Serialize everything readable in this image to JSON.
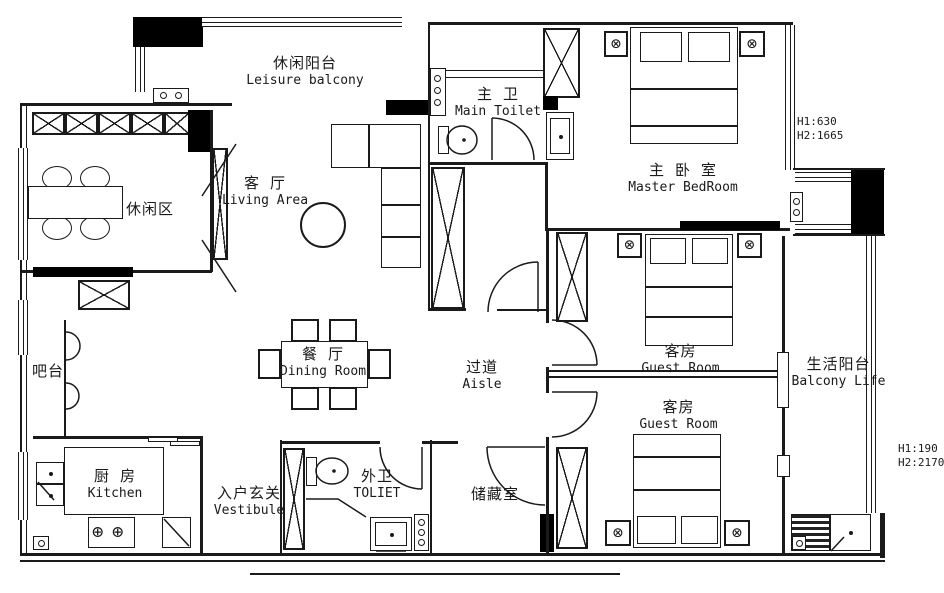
{
  "plan": {
    "rooms": {
      "leisure_balcony": {
        "zh": "休闲阳台",
        "en": "Leisure balcony"
      },
      "main_toilet": {
        "zh": "主 卫",
        "en": "Main Toilet"
      },
      "master_bedroom": {
        "zh": "主 卧 室",
        "en": "Master BedRoom"
      },
      "leisure_area": {
        "zh": "休闲区",
        "en": ""
      },
      "living_area": {
        "zh": "客 厅",
        "en": "Living Area"
      },
      "dining_room": {
        "zh": "餐 厅",
        "en": "Dining Room"
      },
      "aisle": {
        "zh": "过道",
        "en": "Aisle"
      },
      "guest_room_upper": {
        "zh": "客房",
        "en": "Guest Room"
      },
      "guest_room_lower": {
        "zh": "客房",
        "en": "Guest Room"
      },
      "balcony_life": {
        "zh": "生活阳台",
        "en": "Balcony Life"
      },
      "bar": {
        "zh": "吧台",
        "en": ""
      },
      "kitchen": {
        "zh": "厨 房",
        "en": "Kitchen"
      },
      "vestibule": {
        "zh": "入户玄关",
        "en": "Vestibule"
      },
      "outer_toilet": {
        "zh": "外卫",
        "en": "TOLIET"
      },
      "storage": {
        "zh": "储藏室",
        "en": ""
      }
    },
    "annotations": {
      "master_window": {
        "l1": "H1:630",
        "l2": "H2:1665"
      },
      "balcony_window": {
        "l1": "H1:190",
        "l2": "H2:2170"
      }
    },
    "icons": {
      "ceiling_lamp": "⊗",
      "stove_burner": "⊕"
    },
    "colors": {
      "line": "#1a1a1a",
      "background": "#ffffff"
    }
  }
}
